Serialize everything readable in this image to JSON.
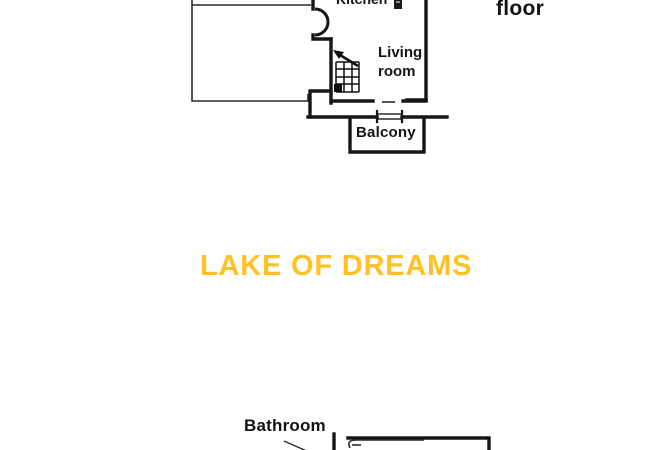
{
  "page": {
    "background_color": "#ffffff",
    "line_color": "#1a1a1a",
    "label_color": "#141414"
  },
  "upper_floorplan": {
    "floor_label": "floor",
    "kitchen_label": "Kitchen",
    "living_room_label_line1": "Living",
    "living_room_label_line2": "room",
    "balcony_label": "Balcony",
    "icons": {
      "door_swing": "door-arc-icon",
      "stairs": "stairs-icon",
      "appliance": "kitchen-appliance-icon"
    }
  },
  "watermark": {
    "text": "LAKE OF DREAMS",
    "color": "#FFC125"
  },
  "lower_floorplan": {
    "bathroom_label": "Bathroom"
  }
}
